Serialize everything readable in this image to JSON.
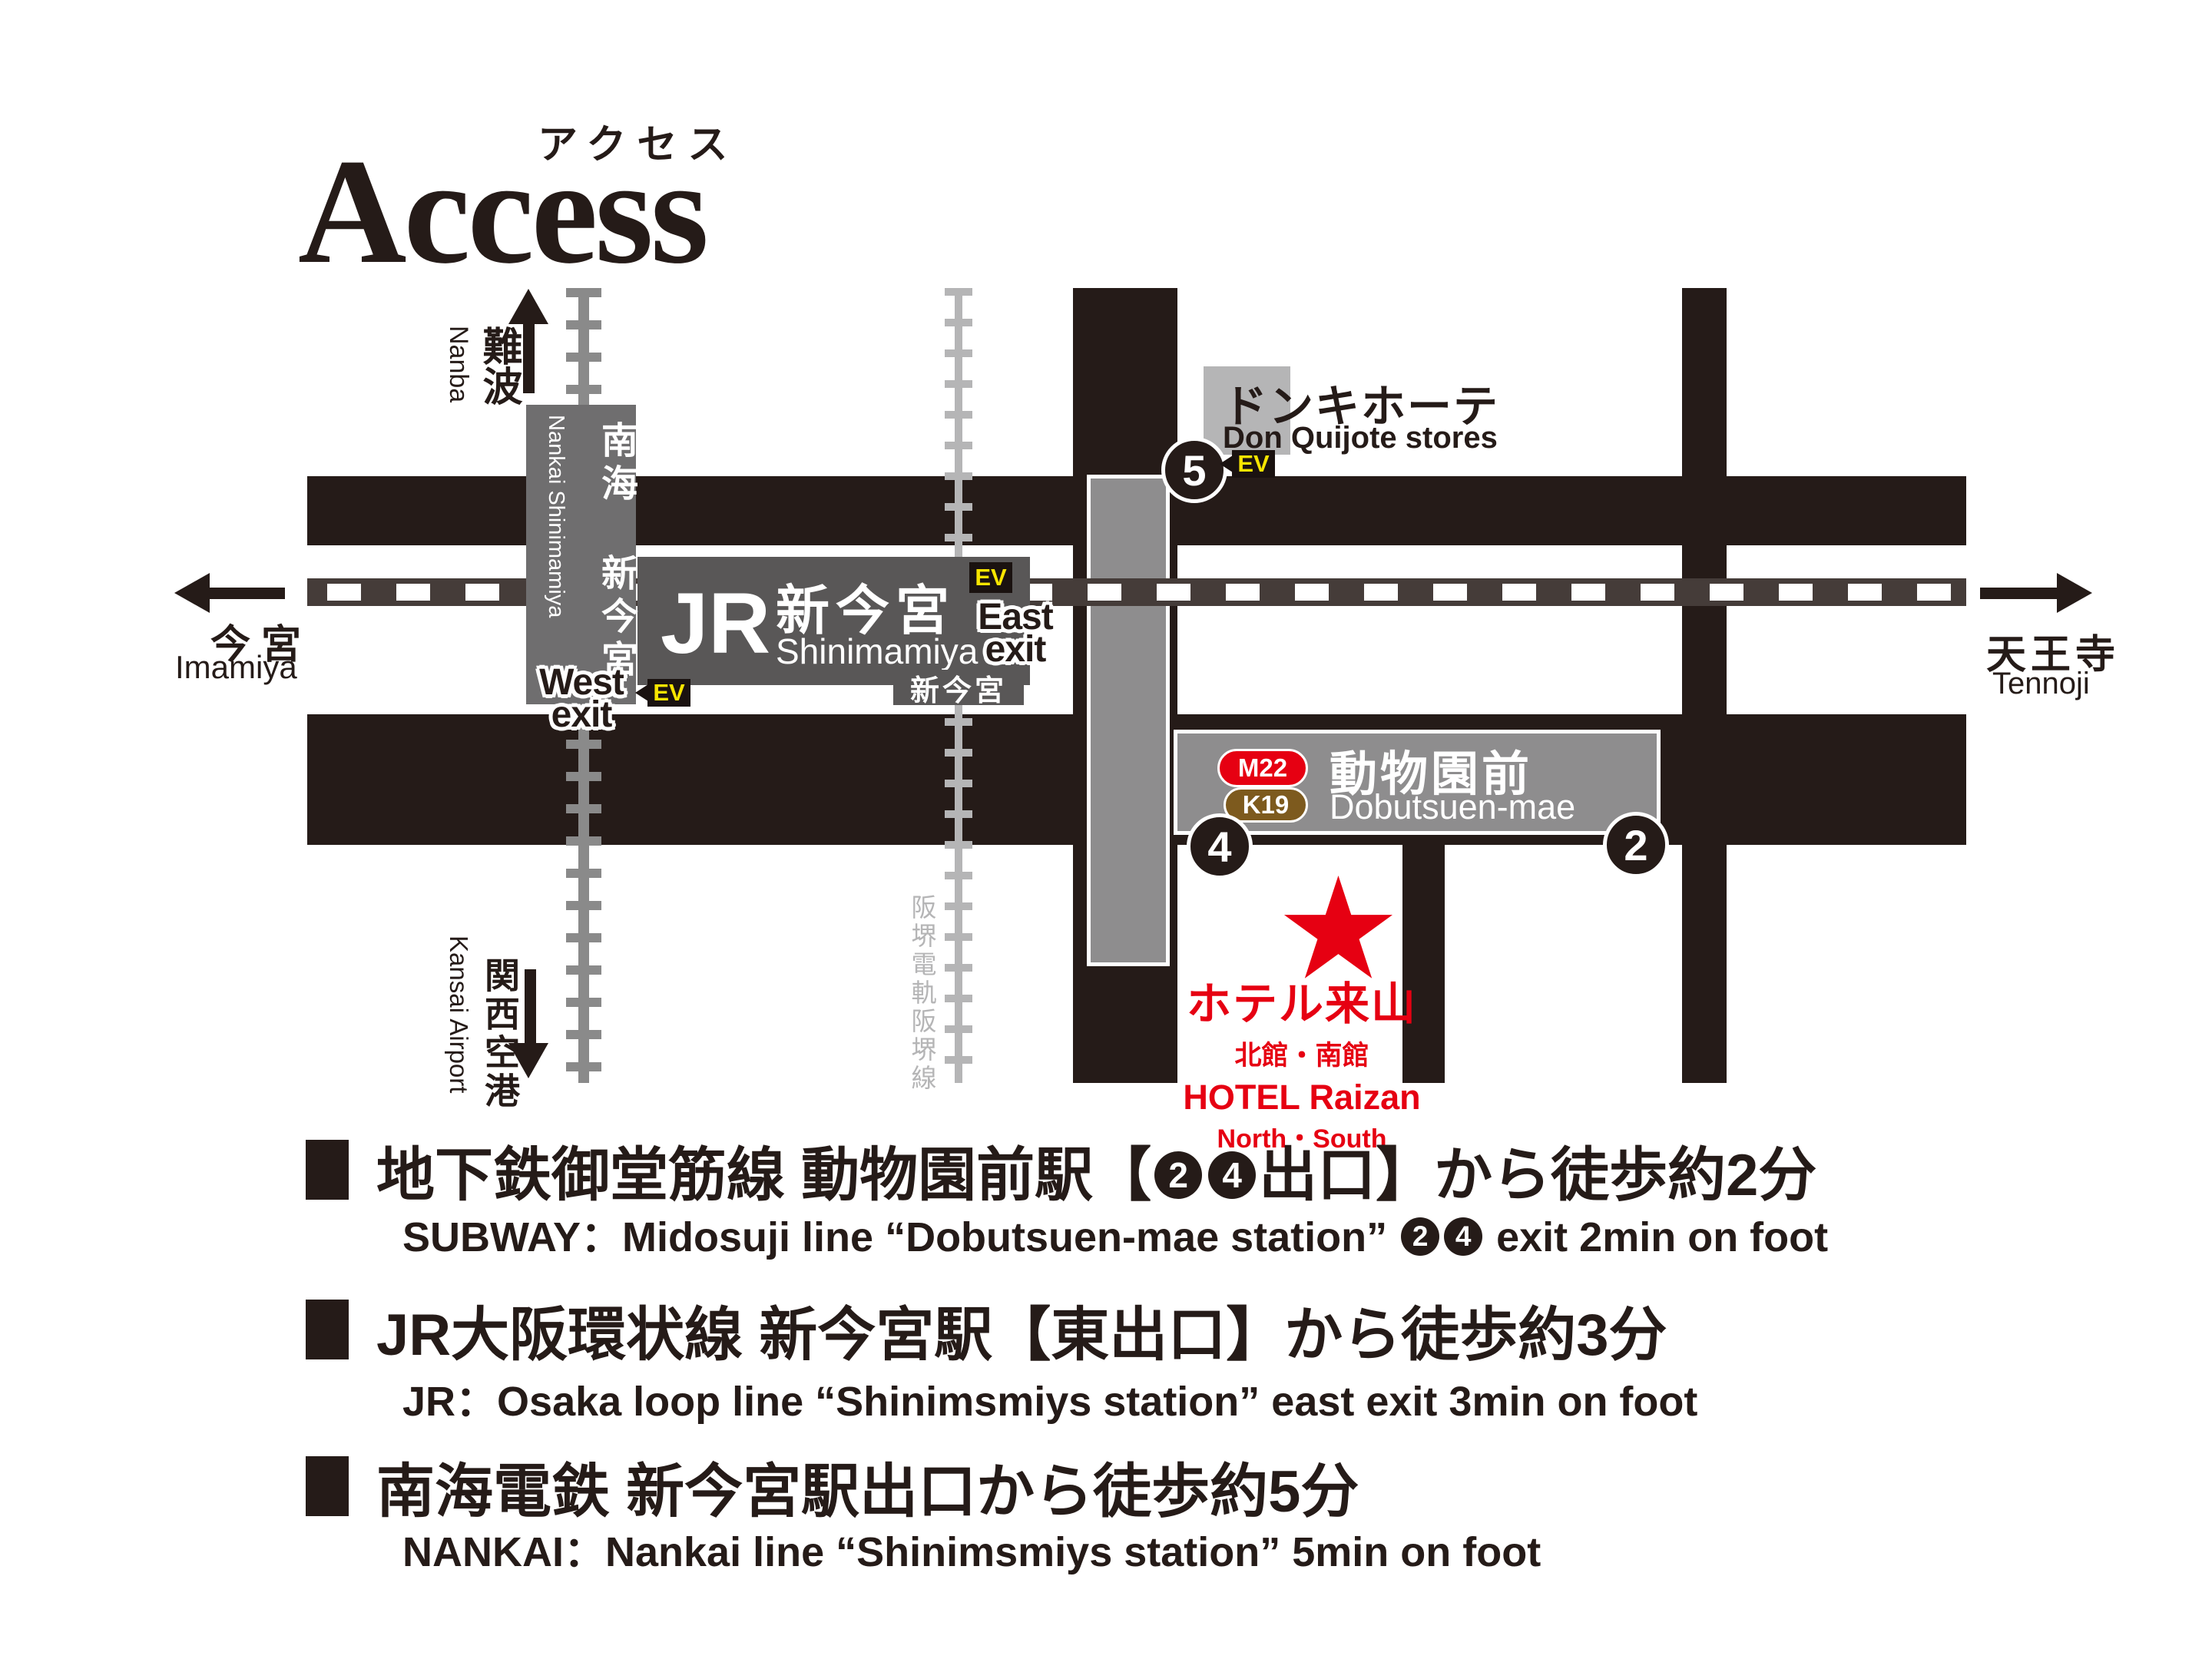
{
  "title": {
    "en": "Access",
    "ja": "アクセス"
  },
  "map": {
    "directions": {
      "nanba": {
        "ja": "難波",
        "en": "Nanba"
      },
      "kansai": {
        "ja": "関西空港",
        "en": "Kansai Airport"
      },
      "imamiya": {
        "ja": "今宮",
        "en": "Imamiya"
      },
      "tennoji": {
        "ja": "天王寺",
        "en": "Tennoji"
      }
    },
    "hankai_line_label": "阪堺電軌阪堺線",
    "stations": {
      "nankai": {
        "ja": "南海 新今宮",
        "en": "Nankai Shinimamiya"
      },
      "jr": {
        "mark": "JR",
        "ja": "新今宮",
        "en": "Shinimamiya"
      },
      "tram_stop": "新今宮",
      "subway": {
        "line_badge_1": "M22",
        "line_badge_2": "K19",
        "ja": "動物園前",
        "en": "Dobutsuen-mae"
      }
    },
    "exits": {
      "ev": "EV",
      "east_line1": "East",
      "east_line2": "exit",
      "west_line1": "West",
      "west_line2": "exit",
      "num5": "5",
      "num4": "4",
      "num2": "2"
    },
    "donki": {
      "ja": "ドンキホーテ",
      "en": "Don Quijote stores"
    },
    "hotel": {
      "star": "★",
      "ja": "ホテル来山",
      "annex": "北館・南館",
      "en": "HOTEL Raizan",
      "en2": "North・South"
    }
  },
  "notes": [
    {
      "jp_pre": "地下鉄御堂筋線 動物園前駅【",
      "badge1": "2",
      "badge2": "4",
      "jp_post": "出口】から徒歩約2分",
      "en_pre": "SUBWAY：Midosuji line “Dobutsuen-mae station” ",
      "en_post": " exit 2min on foot"
    },
    {
      "jp": "JR大阪環状線 新今宮駅【東出口】から徒歩約3分",
      "en": "JR：Osaka loop line “Shinimsmiys station” east exit 3min on foot"
    },
    {
      "jp": "南海電鉄 新今宮駅出口から徒歩約5分",
      "en": "NANKAI：Nankai line “Shinimsmiys station” 5min on foot"
    }
  ],
  "colors": {
    "road_black": "#251b18",
    "accent_red": "#e60012",
    "midosuji_m22": "#e60012",
    "sakaisuji_k19": "#7d5a1e",
    "ev_yellow": "#f8e500",
    "station_gray": "#8e8d8e"
  }
}
